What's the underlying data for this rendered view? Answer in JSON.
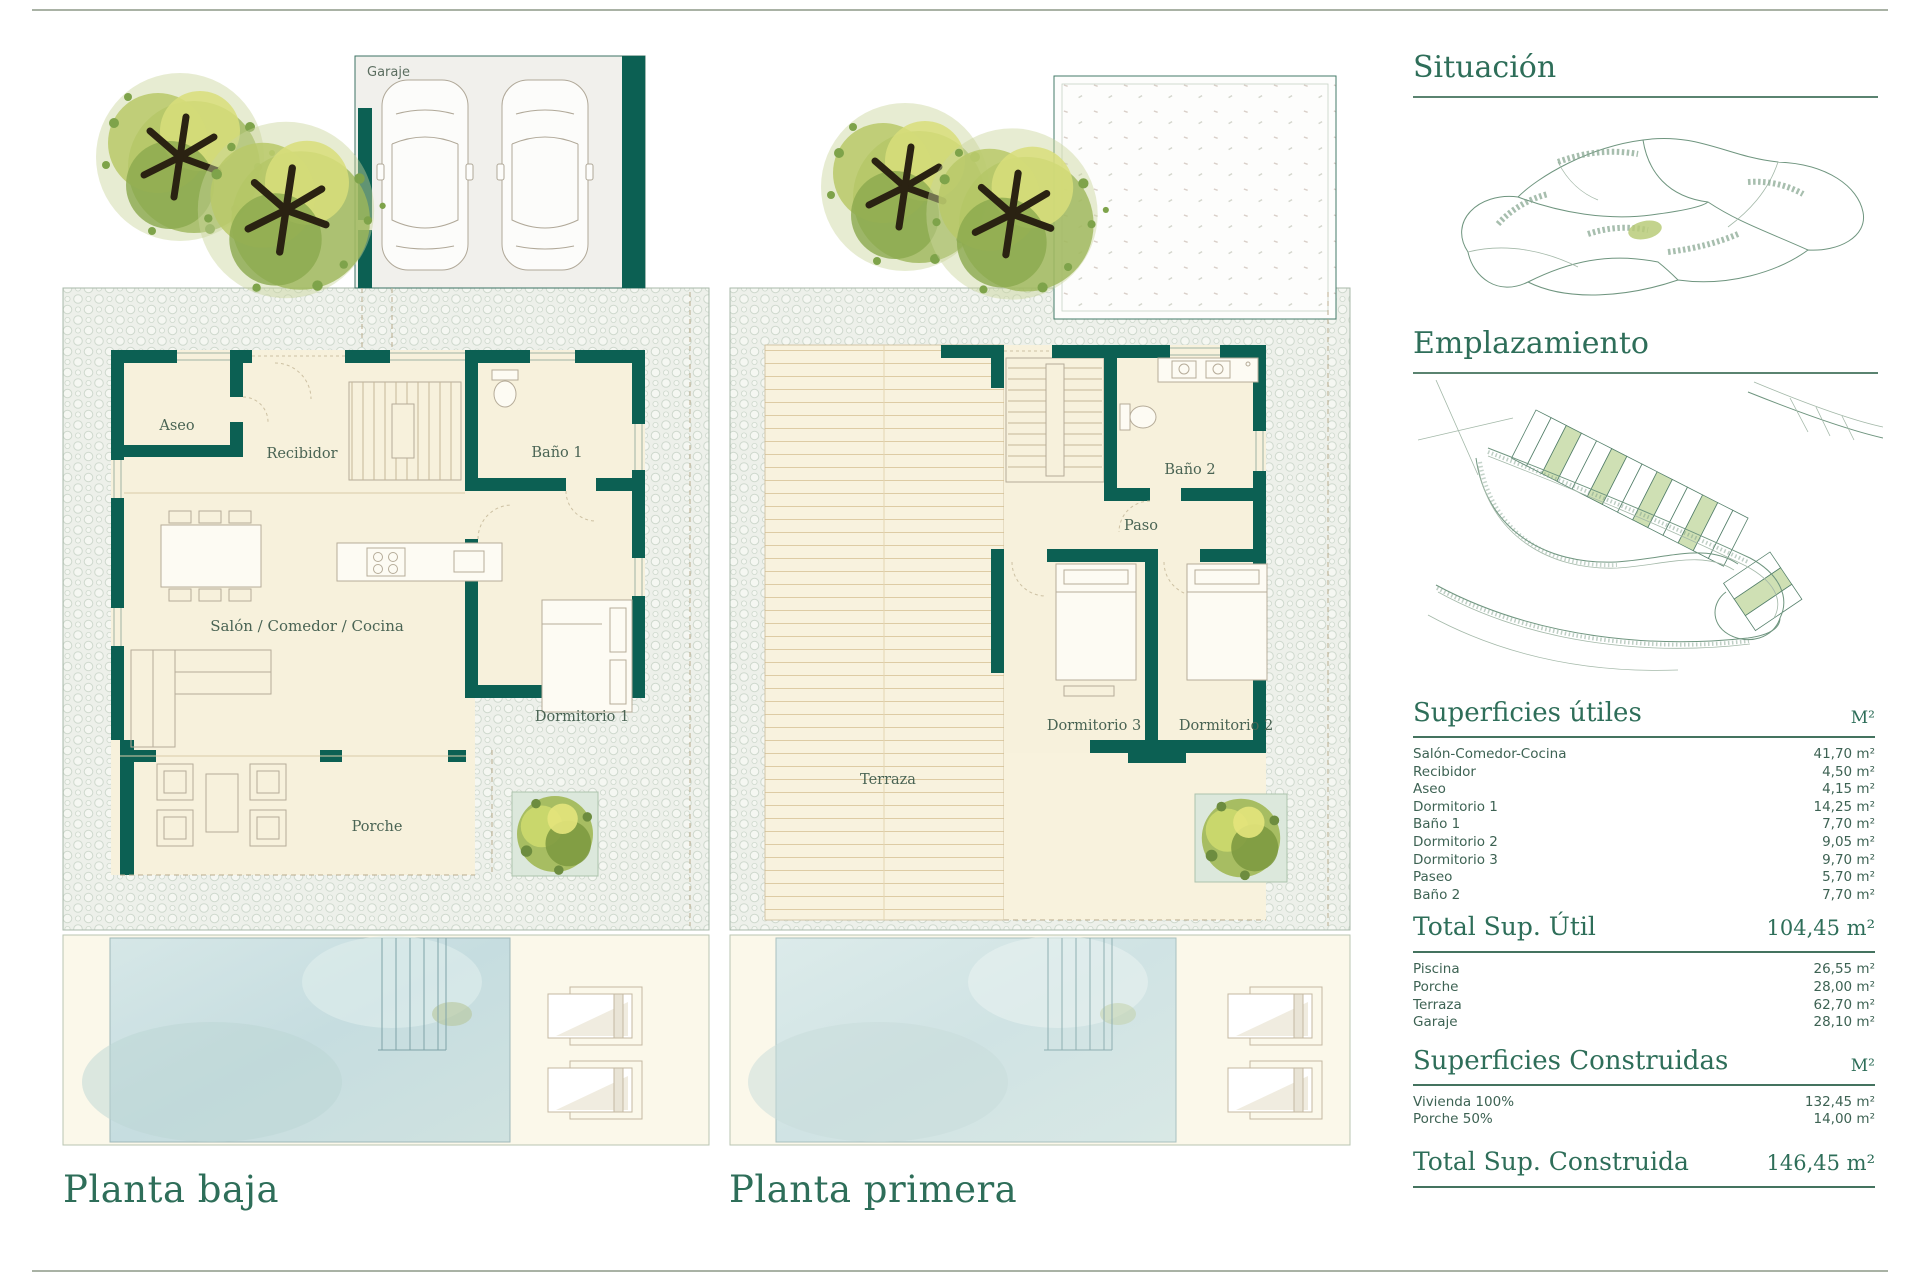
{
  "palette": {
    "wall_teal": "#0c6053",
    "heading_green": "#2e6e59",
    "room_label": "#4a6454",
    "floor_cream": "#f7f1dc",
    "pool_blue": "#cbe0e2",
    "parcel_green": "#cfe0b4",
    "pebble_bg": "#edf0ea"
  },
  "plans": {
    "ground": {
      "title": "Planta baja",
      "garage_label": "Garaje",
      "labels": {
        "aseo": "Aseo",
        "recibidor": "Recibidor",
        "bano1": "Baño 1",
        "salon": "Salón / Comedor / Cocina",
        "dormitorio1": "Dormitorio 1",
        "porche": "Porche"
      }
    },
    "first": {
      "title": "Planta primera",
      "labels": {
        "terraza": "Terraza",
        "bano2": "Baño 2",
        "paso": "Paso",
        "dormitorio3": "Dormitorio 3",
        "dormitorio2": "Dormitorio 2"
      }
    }
  },
  "sidebar": {
    "situacion": {
      "title": "Situación"
    },
    "emplazamiento": {
      "title": "Emplazamiento"
    },
    "superficies_utiles": {
      "title": "Superficies útiles",
      "unit": "M²",
      "rows": [
        {
          "label": "Salón-Comedor-Cocina",
          "value": "41,70 m²"
        },
        {
          "label": "Recibidor",
          "value": "4,50 m²"
        },
        {
          "label": "Aseo",
          "value": "4,15 m²"
        },
        {
          "label": "Dormitorio 1",
          "value": "14,25 m²"
        },
        {
          "label": "Baño 1",
          "value": "7,70 m²"
        },
        {
          "label": "Dormitorio 2",
          "value": "9,05 m²"
        },
        {
          "label": "Dormitorio 3",
          "value": "9,70 m²"
        },
        {
          "label": "Paseo",
          "value": "5,70 m²"
        },
        {
          "label": "Baño 2",
          "value": "7,70 m²"
        }
      ]
    },
    "total_util": {
      "label": "Total Sup. Útil",
      "value": "104,45 m²"
    },
    "superficies_exteriores": {
      "rows": [
        {
          "label": "Piscina",
          "value": "26,55 m²"
        },
        {
          "label": "Porche",
          "value": "28,00 m²"
        },
        {
          "label": "Terraza",
          "value": "62,70 m²"
        },
        {
          "label": "Garaje",
          "value": "28,10 m²"
        }
      ]
    },
    "superficies_construidas": {
      "title": "Superficies Construidas",
      "unit": "M²",
      "rows": [
        {
          "label": "Vivienda 100%",
          "value": "132,45 m²"
        },
        {
          "label": "Porche 50%",
          "value": "14,00 m²"
        }
      ]
    },
    "total_construida": {
      "label": "Total Sup. Construida",
      "value": "146,45 m²"
    }
  }
}
